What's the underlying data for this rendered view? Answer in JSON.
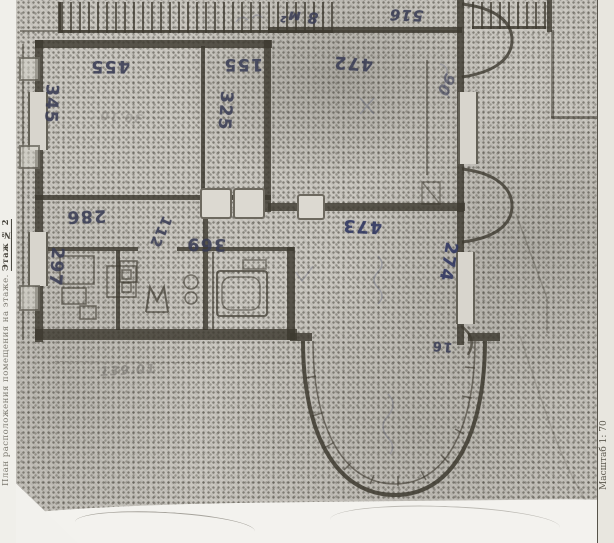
{
  "page": {
    "left_margin_caption": "План расположения помещения на этаже.",
    "floor_note": "Этаж № 2",
    "scale_caption": "Масштаб 1: 70"
  },
  "plan_labels": {
    "room1_width": "455",
    "room1_depth": "345",
    "room2_width": "155",
    "room2_depth": "325",
    "room3_width": "472",
    "hall_width": "286",
    "hall_depth": "297",
    "passage_width": "112",
    "corridor_width": "369",
    "room4_width": "473",
    "room4_depth": "274",
    "bay_offset": "16"
  },
  "handwritten_notes": {
    "area_note": "8 м²",
    "number_note": "516",
    "margin_squiggle": "90",
    "pencil_total": "139.01",
    "room1_pencil": "30.10"
  },
  "colors": {
    "ink": "#3a3d55",
    "ink-blue": "#2e3560",
    "pencil": "#6e6b66",
    "wall": "#3d392f",
    "paper": "#cbc8c1"
  }
}
